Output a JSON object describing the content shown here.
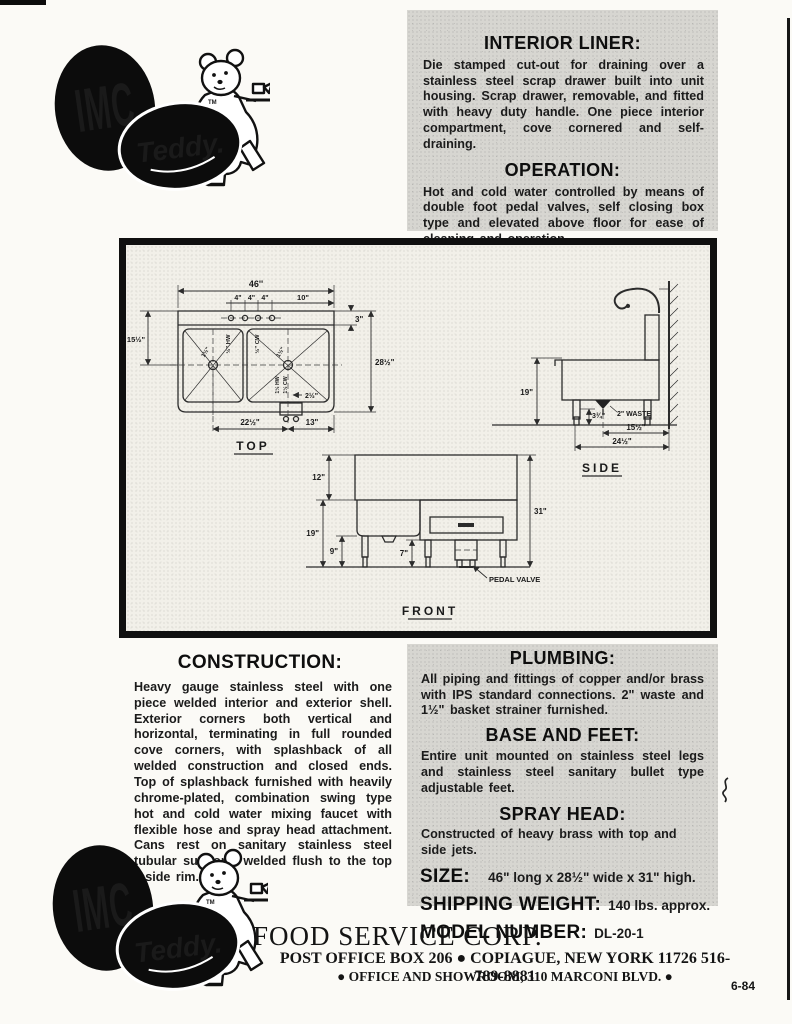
{
  "logo": {
    "imc": "IMC",
    "teddy": "Teddy.",
    "tm": "TM"
  },
  "sections": {
    "interior_liner": {
      "heading": "INTERIOR LINER:",
      "body": "Die stamped cut-out for draining over a stainless steel scrap drawer built into unit housing. Scrap drawer, removable, and fitted with heavy duty handle. One piece interior compartment, cove cornered and self-draining."
    },
    "operation": {
      "heading": "OPERATION:",
      "body": "Hot and cold water controlled by means of double foot pedal valves, self closing box type and elevated above floor for ease of cleaning and operation."
    },
    "construction": {
      "heading": "CONSTRUCTION:",
      "body": "Heavy gauge stainless steel with one piece welded interior and exterior shell. Exterior corners both vertical and horizontal, terminating in full rounded cove corners, with splashback of all welded construction and closed ends. Top of splashback furnished with heavily chrome-plated, combination swing type hot and cold water mixing faucet with flexible hose and spray head attachment. Cans rest on sanitary stainless steel tubular supports welded flush to the top inside rim."
    },
    "plumbing": {
      "heading": "PLUMBING:",
      "body": "All piping and fittings of copper and/or brass with IPS standard connections. 2\" waste and 1½\" basket strainer furnished."
    },
    "base_feet": {
      "heading": "BASE AND FEET:",
      "body": "Entire unit mounted on stainless steel legs and stainless steel sanitary bullet type adjustable feet."
    },
    "spray_head": {
      "heading": "SPRAY HEAD:",
      "body": "Constructed of heavy brass with top and side jets."
    }
  },
  "specs": {
    "size_label": "SIZE:",
    "size_value": "46\" long x 28½\" wide x 31\" high.",
    "weight_label": "SHIPPING WEIGHT:",
    "weight_value": "140 lbs. approx.",
    "model_label": "MODEL NUMBER:",
    "model_value": "DL-20-1"
  },
  "drawing": {
    "top": {
      "view_label": "TOP",
      "overall_width": "46''",
      "hole_spacing": [
        "4\"",
        "4\"",
        "4\""
      ],
      "right_offset": "10\"",
      "splash_depth": "3\"",
      "left_dim": "15½\"",
      "depth": "28½\"",
      "basin_span": "22½\"",
      "valve_offset": "13\"",
      "hw_label": "½\" HW",
      "cw_label": "½\" CW",
      "drain_left": "1½\"",
      "drain_right": "1½\"",
      "valve_hw": "1½ HW",
      "valve_cw": "1½ CW",
      "valve_dim": "2½\""
    },
    "side": {
      "view_label": "SIDE",
      "height_dim": "19\"",
      "foot_dim": "3¾\"",
      "waste_label": "2\" WASTE",
      "dim_15": "15½\"",
      "dim_24": "24½\""
    },
    "front": {
      "view_label": "FRONT",
      "splash_dim": "12\"",
      "body_dim": "19\"",
      "leg_dim": "9\"",
      "valve_dim": "7\"",
      "overall_height": "31\"",
      "pedal_valve_label": "PEDAL VALVE"
    }
  },
  "footer": {
    "company": "FOOD SERVICE CORP.",
    "line1": "POST OFFICE BOX 206 ● COPIAGUE, NEW YORK 11726   516-789-8881",
    "line2": "● OFFICE AND SHOWROOM, 310 MARCONI BLVD. ●",
    "code": "6-84"
  }
}
